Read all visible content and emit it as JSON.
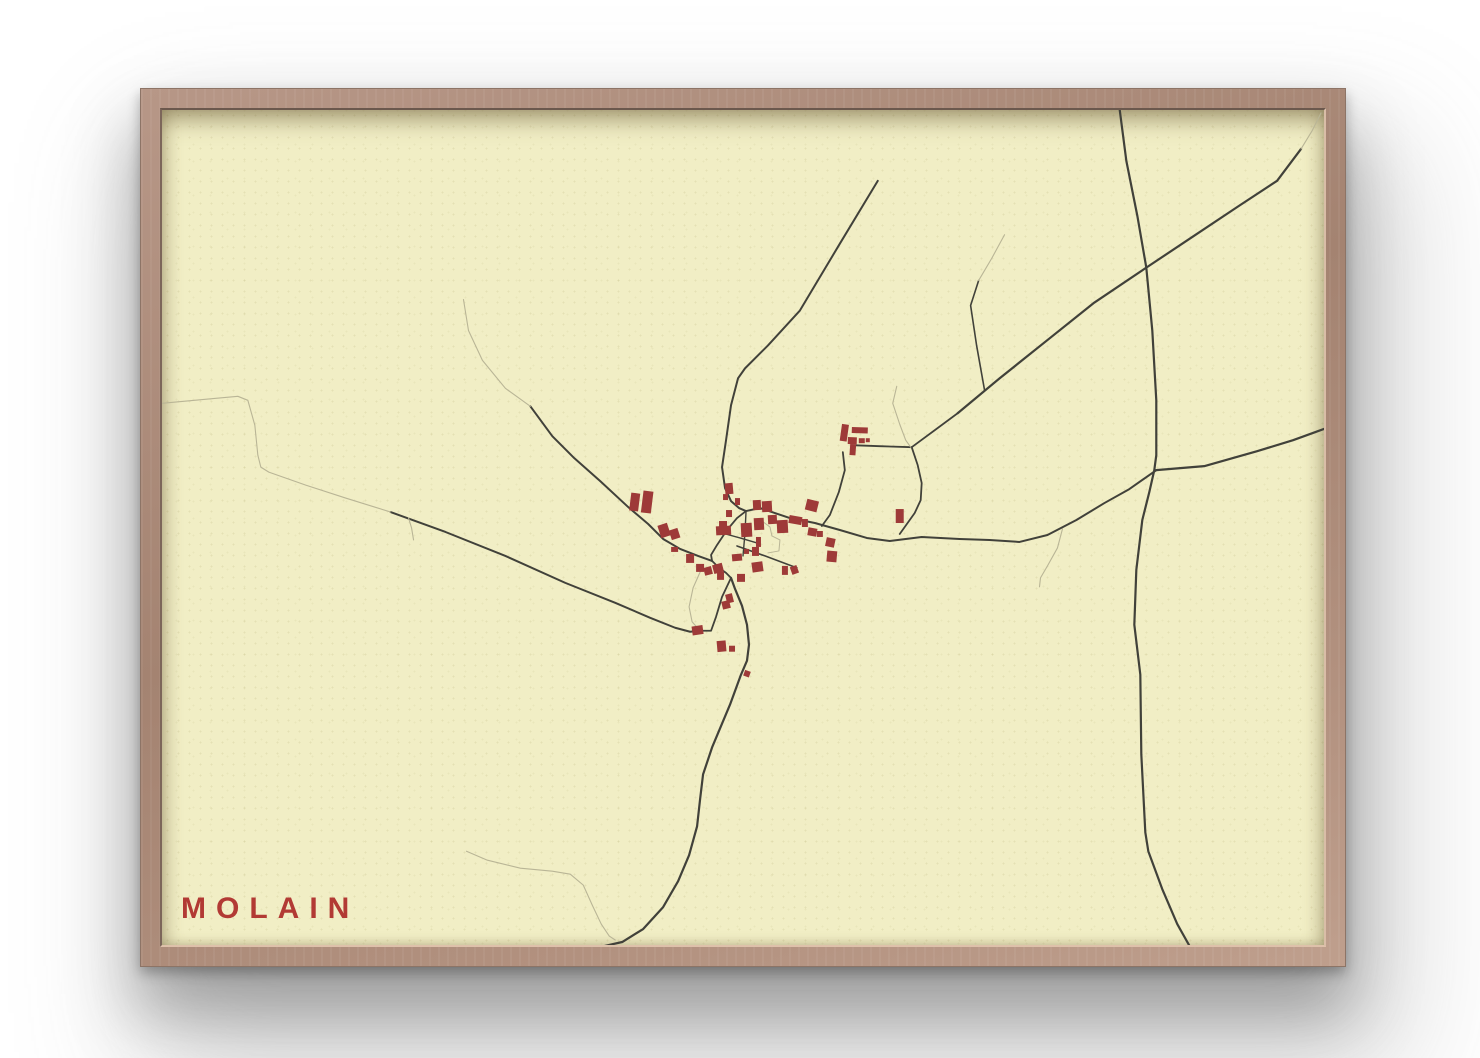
{
  "poster": {
    "title": "MOLAIN",
    "title_color": "#b23a34",
    "paper_color": "#f1eec5",
    "frame_wood_color": "#ab8a79",
    "road_dark_color": "#41413650",
    "colors": {
      "road_dark": "#41413a",
      "road_light": "#b9b596",
      "building": "#9e3a38"
    }
  },
  "map": {
    "viewbox": "161 109 1164 837",
    "roads": [
      {
        "tone": "dark",
        "w": 2.2,
        "points": "1120,106 1127,160 1138,215 1147,267 1153,330 1157,400 1157,455 1155,470 1150,492 1143,520 1137,570 1135,625 1141,675 1142,755 1146,833 1149,852 1163,890 1178,925 1192,950"
      },
      {
        "tone": "dark",
        "w": 2.2,
        "points": "958,413 1000,378 1050,338 1095,302 1147,267 1195,235 1240,205 1278,180 1302,148"
      },
      {
        "tone": "dark",
        "w": 2.2,
        "points": "1157,470 1205,466 1258,451 1294,440 1327,428"
      },
      {
        "tone": "dark",
        "w": 2.0,
        "points": "746,511 760,508 775,513 790,518 815,523 840,530 867,538 890,541 922,537 960,539 990,540 1020,542 1048,535 1077,520 1105,503 1130,489 1157,470"
      },
      {
        "tone": "dark",
        "w": 1.8,
        "points": "843,452 845,470 839,492 830,515 822,526"
      },
      {
        "tone": "dark",
        "w": 1.8,
        "points": "852,445 880,446 912,447"
      },
      {
        "tone": "dark",
        "w": 1.8,
        "points": "912,447 935,430 958,413"
      },
      {
        "tone": "dark",
        "w": 1.8,
        "points": "912,447 918,465 922,483 921,500 915,513 905,527 900,534"
      },
      {
        "tone": "dark",
        "w": 2.0,
        "points": "878,180 840,243 800,310 768,345 745,368 738,378 731,405 726,440 722,467 725,488 731,501 739,508 746,511"
      },
      {
        "tone": "dark",
        "w": 2.0,
        "points": "530,406 552,436 574,458 600,481 628,507 648,524 663,539 680,549 698,556 712,561"
      },
      {
        "tone": "dark",
        "w": 2.0,
        "points": "390,512 445,532 505,556 565,583 615,603 650,618 675,628 690,632 700,631"
      },
      {
        "tone": "dark",
        "w": 1.8,
        "points": "746,511 737,518 727,530 717,545 711,555 712,561"
      },
      {
        "tone": "dark",
        "w": 1.8,
        "points": "712,561 719,568 726,573 731,578"
      },
      {
        "tone": "dark",
        "w": 1.8,
        "points": "700,631 711,631 716,617 722,597 731,578"
      },
      {
        "tone": "dark",
        "w": 2.2,
        "points": "731,578 735,589 742,606 747,625 749,645 747,661 741,675 730,705 712,748 703,775 700,800 697,827 689,856 678,882 663,908 643,930 622,943 600,948 588,951"
      },
      {
        "tone": "dark",
        "w": 1.6,
        "points": "737,546 765,556 797,568"
      },
      {
        "tone": "dark",
        "w": 1.4,
        "points": "746,512 745,533 743,556"
      },
      {
        "tone": "dark",
        "w": 1.4,
        "points": "722,533 740,538 757,543"
      },
      {
        "tone": "dark",
        "w": 1.6,
        "points": "985,390 977,345 971,305 979,280"
      },
      {
        "tone": "light",
        "w": 1.1,
        "points": "161,403 215,398 237,396 247,400 254,425 257,455 260,467 268,472 305,485 345,498 390,512"
      },
      {
        "tone": "light",
        "w": 1.1,
        "points": "408,518 411,528 413,540"
      },
      {
        "tone": "light",
        "w": 1.1,
        "points": "463,299 468,330 482,360 505,388 530,406"
      },
      {
        "tone": "light",
        "w": 1.1,
        "points": "979,280 992,258 1005,234"
      },
      {
        "tone": "light",
        "w": 1.1,
        "points": "1302,148 1313,130 1322,112"
      },
      {
        "tone": "light",
        "w": 1.1,
        "points": "1063,529 1058,548 1048,566 1041,578 1040,587"
      },
      {
        "tone": "light",
        "w": 1.1,
        "points": "466,852 487,861 520,869 552,872 570,875 583,886 592,906 601,925 609,937 615,941"
      },
      {
        "tone": "light",
        "w": 1.1,
        "points": "701,570 693,588 689,607 692,622 699,630"
      },
      {
        "tone": "light",
        "w": 1.1,
        "points": "897,386 893,403 900,424 906,440 911,447"
      },
      {
        "tone": "light",
        "w": 1.0,
        "points": "762,521 770,527 772,536 780,540 779,551 768,553"
      }
    ],
    "buildings": [
      {
        "x": 841,
        "y": 424,
        "w": 7,
        "h": 17,
        "r": 8
      },
      {
        "x": 852,
        "y": 427,
        "w": 16,
        "h": 6,
        "r": 2
      },
      {
        "x": 848,
        "y": 437,
        "w": 9,
        "h": 7,
        "r": 2
      },
      {
        "x": 859,
        "y": 438,
        "w": 6,
        "h": 5,
        "r": 0
      },
      {
        "x": 866,
        "y": 438,
        "w": 4,
        "h": 4,
        "r": 0
      },
      {
        "x": 850,
        "y": 444,
        "w": 6,
        "h": 11,
        "r": 4
      },
      {
        "x": 896,
        "y": 509,
        "w": 8,
        "h": 14,
        "r": 0
      },
      {
        "x": 630,
        "y": 493,
        "w": 9,
        "h": 18,
        "r": 7
      },
      {
        "x": 642,
        "y": 491,
        "w": 10,
        "h": 22,
        "r": 7
      },
      {
        "x": 659,
        "y": 524,
        "w": 10,
        "h": 13,
        "r": -18
      },
      {
        "x": 670,
        "y": 529,
        "w": 9,
        "h": 10,
        "r": -18
      },
      {
        "x": 671,
        "y": 547,
        "w": 7,
        "h": 5,
        "r": 0
      },
      {
        "x": 686,
        "y": 554,
        "w": 8,
        "h": 9,
        "r": 0
      },
      {
        "x": 696,
        "y": 564,
        "w": 8,
        "h": 8,
        "r": 0
      },
      {
        "x": 704,
        "y": 567,
        "w": 8,
        "h": 8,
        "r": -15
      },
      {
        "x": 713,
        "y": 564,
        "w": 10,
        "h": 9,
        "r": -15
      },
      {
        "x": 692,
        "y": 626,
        "w": 11,
        "h": 9,
        "r": -8
      },
      {
        "x": 717,
        "y": 641,
        "w": 9,
        "h": 11,
        "r": -5
      },
      {
        "x": 729,
        "y": 646,
        "w": 6,
        "h": 6,
        "r": 0
      },
      {
        "x": 744,
        "y": 671,
        "w": 6,
        "h": 6,
        "r": 20
      },
      {
        "x": 725,
        "y": 483,
        "w": 8,
        "h": 11,
        "r": -5
      },
      {
        "x": 723,
        "y": 494,
        "w": 5,
        "h": 6,
        "r": 0
      },
      {
        "x": 735,
        "y": 498,
        "w": 5,
        "h": 7,
        "r": 0
      },
      {
        "x": 726,
        "y": 510,
        "w": 6,
        "h": 7,
        "r": 0
      },
      {
        "x": 719,
        "y": 521,
        "w": 8,
        "h": 7,
        "r": 0
      },
      {
        "x": 716,
        "y": 526,
        "w": 15,
        "h": 9,
        "r": -3
      },
      {
        "x": 741,
        "y": 523,
        "w": 11,
        "h": 14,
        "r": -3
      },
      {
        "x": 753,
        "y": 500,
        "w": 8,
        "h": 10,
        "r": -3
      },
      {
        "x": 762,
        "y": 501,
        "w": 10,
        "h": 11,
        "r": -3
      },
      {
        "x": 754,
        "y": 518,
        "w": 10,
        "h": 12,
        "r": -3
      },
      {
        "x": 768,
        "y": 515,
        "w": 9,
        "h": 9,
        "r": -3
      },
      {
        "x": 777,
        "y": 520,
        "w": 11,
        "h": 13,
        "r": -3
      },
      {
        "x": 789,
        "y": 516,
        "w": 13,
        "h": 8,
        "r": 10
      },
      {
        "x": 802,
        "y": 519,
        "w": 6,
        "h": 8,
        "r": 0
      },
      {
        "x": 806,
        "y": 500,
        "w": 12,
        "h": 11,
        "r": 14
      },
      {
        "x": 808,
        "y": 528,
        "w": 9,
        "h": 8,
        "r": 10
      },
      {
        "x": 817,
        "y": 531,
        "w": 6,
        "h": 6,
        "r": 0
      },
      {
        "x": 826,
        "y": 538,
        "w": 9,
        "h": 9,
        "r": 12
      },
      {
        "x": 827,
        "y": 551,
        "w": 10,
        "h": 11,
        "r": 5
      },
      {
        "x": 756,
        "y": 537,
        "w": 5,
        "h": 10,
        "r": 0
      },
      {
        "x": 752,
        "y": 547,
        "w": 7,
        "h": 9,
        "r": 0
      },
      {
        "x": 744,
        "y": 549,
        "w": 5,
        "h": 5,
        "r": 0
      },
      {
        "x": 732,
        "y": 554,
        "w": 10,
        "h": 7,
        "r": -5
      },
      {
        "x": 752,
        "y": 562,
        "w": 11,
        "h": 10,
        "r": -8
      },
      {
        "x": 782,
        "y": 566,
        "w": 6,
        "h": 9,
        "r": 0
      },
      {
        "x": 791,
        "y": 566,
        "w": 7,
        "h": 8,
        "r": -20
      },
      {
        "x": 737,
        "y": 574,
        "w": 8,
        "h": 8,
        "r": 0
      },
      {
        "x": 717,
        "y": 572,
        "w": 7,
        "h": 8,
        "r": 0
      },
      {
        "x": 726,
        "y": 594,
        "w": 7,
        "h": 9,
        "r": -14
      },
      {
        "x": 722,
        "y": 601,
        "w": 8,
        "h": 8,
        "r": -14
      }
    ]
  }
}
